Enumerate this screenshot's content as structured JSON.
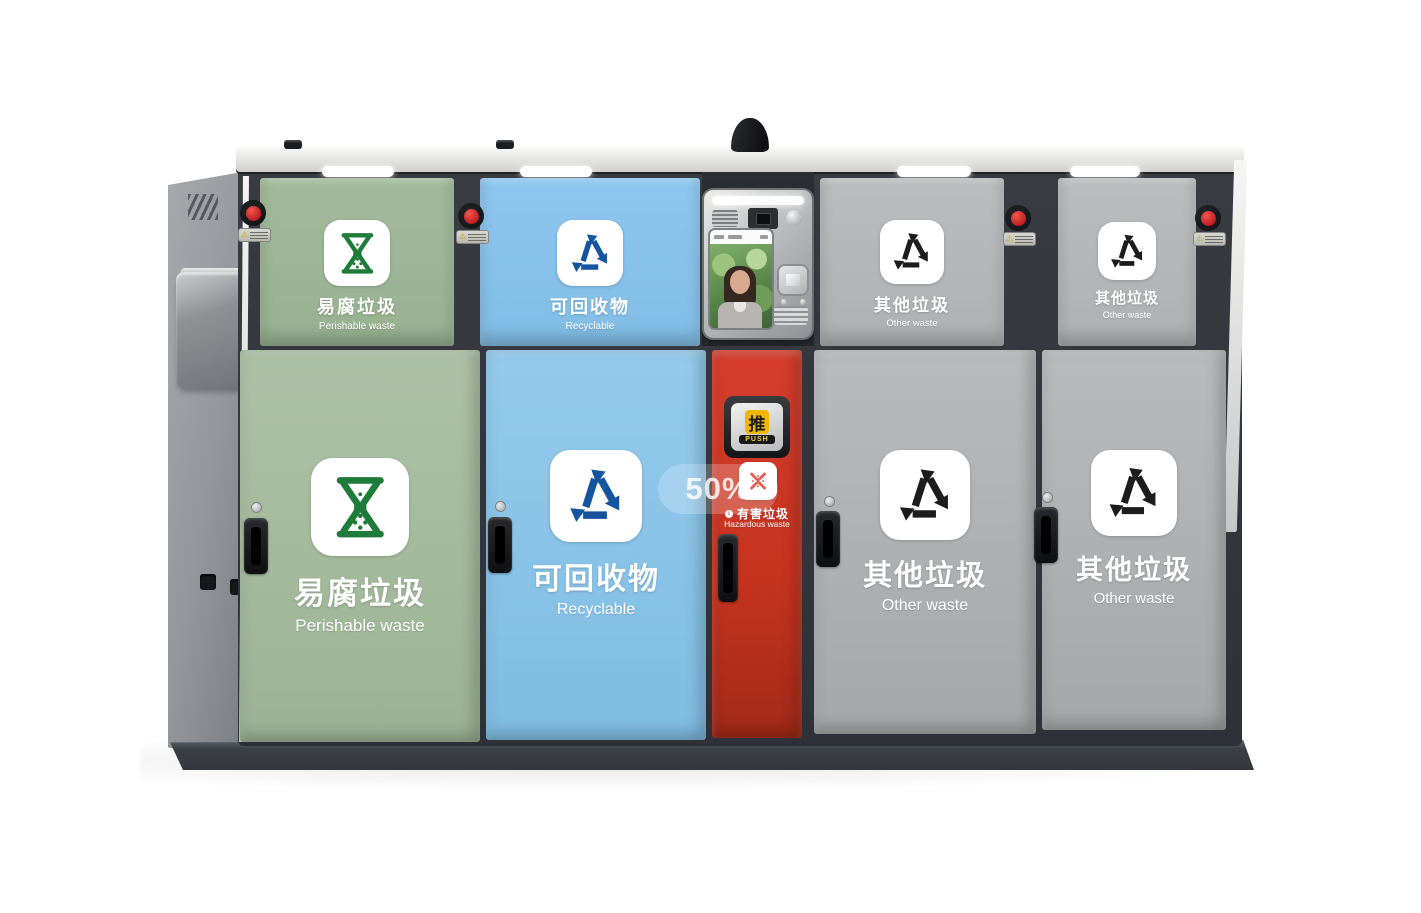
{
  "watermark": {
    "label": "50%"
  },
  "station": {
    "type": "smart-waste-sorting-station",
    "push_flap": {
      "zh": "推",
      "en": "PUSH"
    },
    "categories": {
      "perishable": {
        "zh": "易腐垃圾",
        "en": "Perishable waste",
        "icon": "hourglass-icon",
        "accent": "#1e7b39",
        "panel": "#a6bc9e"
      },
      "recyclable": {
        "zh": "可回收物",
        "en": "Recyclable",
        "icon": "recycle-arrows-icon",
        "accent": "#15559f",
        "panel": "#8fc7eb"
      },
      "hazardous": {
        "zh": "有害垃圾",
        "en": "Hazardous waste",
        "icon": "hazard-x-icon",
        "accent": "#d8352a",
        "panel": "#cf3826"
      },
      "other": {
        "zh": "其他垃圾",
        "en": "Other waste",
        "icon": "triangle-arrows-icon",
        "accent": "#1c1c1c",
        "panel": "#b4b6b7"
      }
    },
    "frame_color": "#33373d",
    "roof_color": "#e9e9e7",
    "emergency_button_color": "#cb2127",
    "warning_icon": "warning-triangle-icon"
  }
}
